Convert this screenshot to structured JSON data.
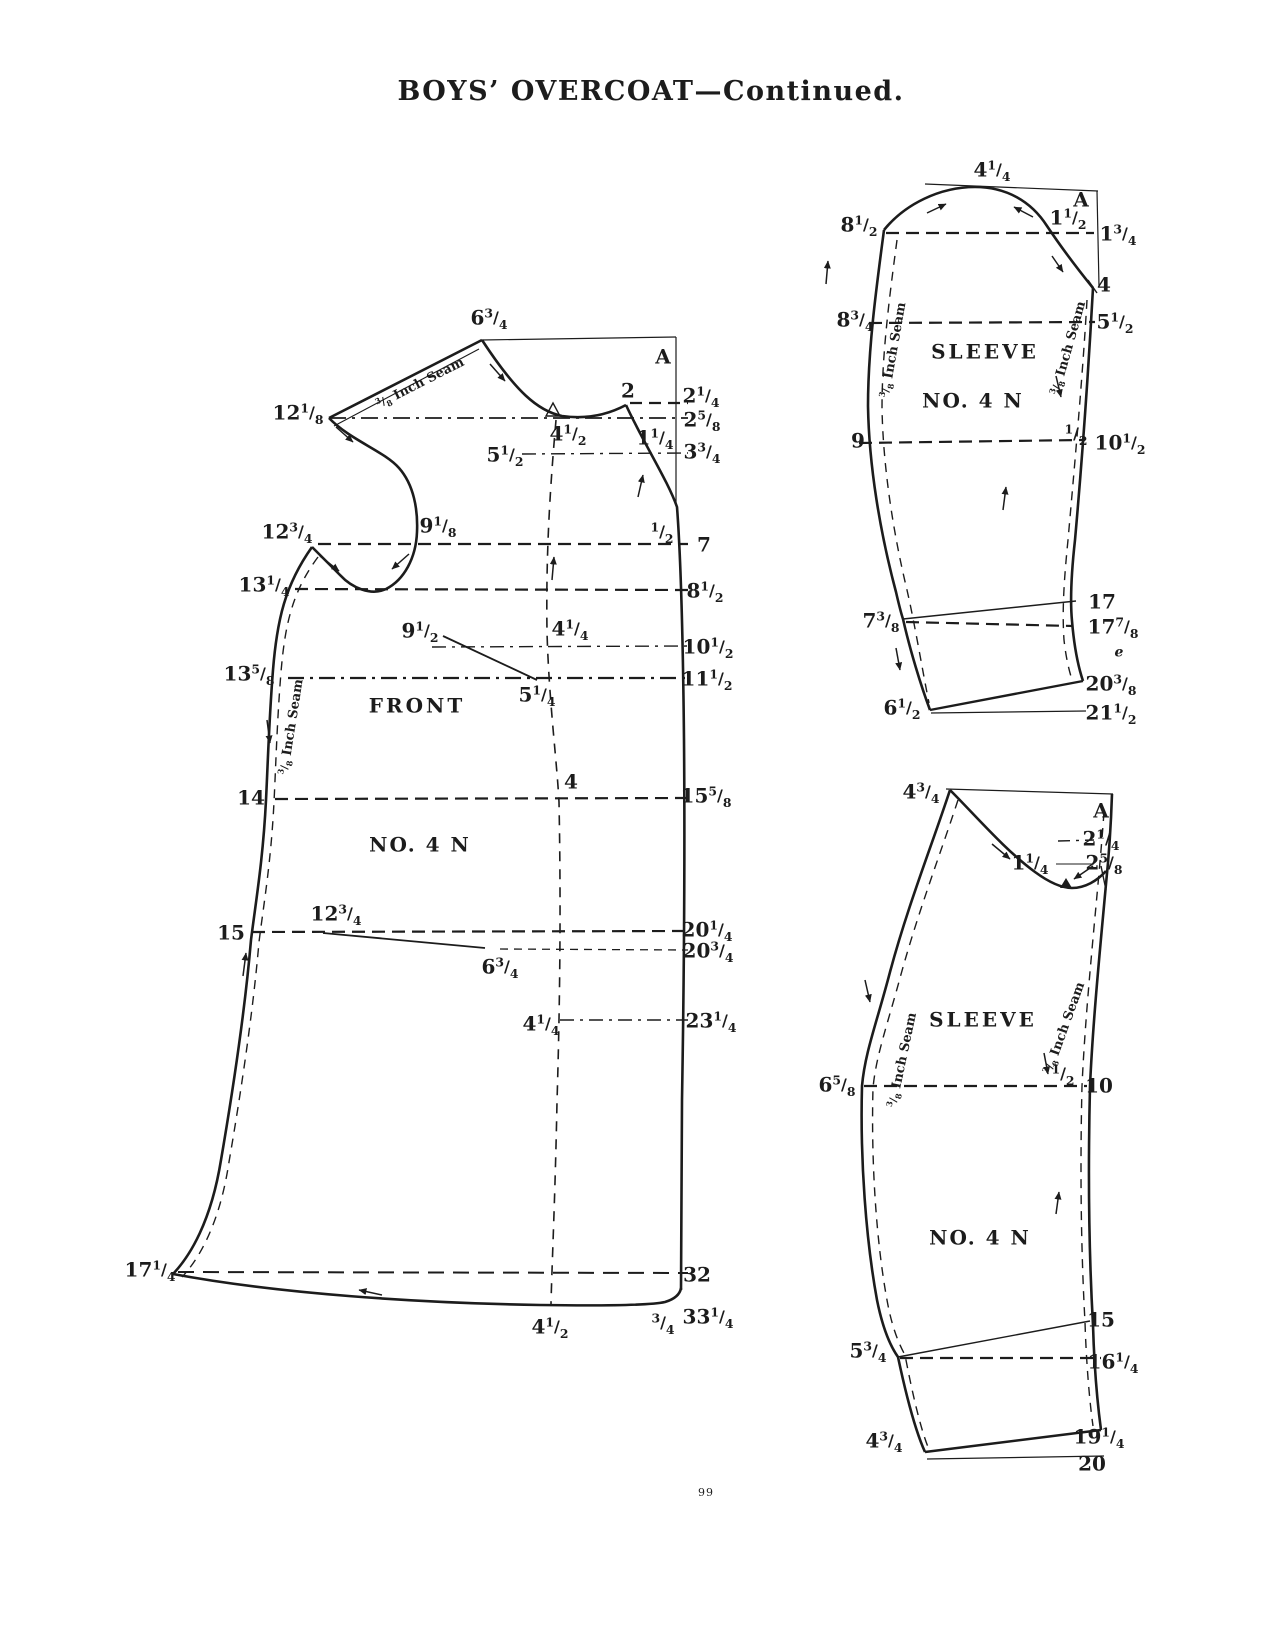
{
  "page": {
    "title": "BOYS’ OVERCOAT—Continued.",
    "page_number": "99"
  },
  "colors": {
    "ink": "#1c1c1c",
    "paper": "#ffffff"
  },
  "pieces": {
    "front": {
      "piece_name": "FRONT",
      "pattern_number": "NO. 4 N",
      "seam_note": "3/8 Inch Seam",
      "labels": [
        {
          "t": "6 3/4",
          "x": 489,
          "y": 318
        },
        {
          "t": "A",
          "x": 663,
          "y": 357,
          "k": "corner-letter"
        },
        {
          "t": "2",
          "x": 628,
          "y": 391
        },
        {
          "t": "2 1/4",
          "x": 701,
          "y": 396
        },
        {
          "t": "2 5/8",
          "x": 702,
          "y": 420
        },
        {
          "t": "4 1/2",
          "x": 568,
          "y": 434
        },
        {
          "t": "1 1/4",
          "x": 655,
          "y": 438
        },
        {
          "t": "5 1/2",
          "x": 505,
          "y": 455
        },
        {
          "t": "3 3/4",
          "x": 702,
          "y": 452
        },
        {
          "t": "12 1/8",
          "x": 298,
          "y": 413
        },
        {
          "t": "9 1/8",
          "x": 438,
          "y": 526
        },
        {
          "t": "12 3/4",
          "x": 287,
          "y": 532
        },
        {
          "t": "1/2",
          "x": 662,
          "y": 532
        },
        {
          "t": "7",
          "x": 704,
          "y": 545
        },
        {
          "t": "13 1/4",
          "x": 264,
          "y": 585
        },
        {
          "t": "8 1/2",
          "x": 705,
          "y": 591
        },
        {
          "t": "9 1/2",
          "x": 420,
          "y": 631
        },
        {
          "t": "4 1/4",
          "x": 570,
          "y": 629
        },
        {
          "t": "10 1/2",
          "x": 708,
          "y": 647
        },
        {
          "t": "13 5/8",
          "x": 249,
          "y": 674
        },
        {
          "t": "11 1/2",
          "x": 707,
          "y": 679
        },
        {
          "t": "5 1/4",
          "x": 537,
          "y": 695
        },
        {
          "t": "FRONT",
          "x": 417,
          "y": 706,
          "k": "piece-name",
          "sp": 3
        },
        {
          "t": "3/8 Inch Seam",
          "x": 420,
          "y": 383,
          "k": "seam-note",
          "r": -27,
          "s": 13
        },
        {
          "t": "3/8 Inch Seam",
          "x": 291,
          "y": 727,
          "k": "seam-note",
          "r": -81,
          "s": 13
        },
        {
          "t": "14",
          "x": 251,
          "y": 798
        },
        {
          "t": "4",
          "x": 571,
          "y": 782
        },
        {
          "t": "15 5/8",
          "x": 706,
          "y": 796
        },
        {
          "t": "NO. 4 N",
          "x": 420,
          "y": 845,
          "k": "piece-number",
          "sp": 2
        },
        {
          "t": "15",
          "x": 231,
          "y": 933
        },
        {
          "t": "12 3/4",
          "x": 336,
          "y": 914
        },
        {
          "t": "20 1/4",
          "x": 707,
          "y": 930
        },
        {
          "t": "20 3/4",
          "x": 708,
          "y": 951
        },
        {
          "t": "6 3/4",
          "x": 500,
          "y": 967
        },
        {
          "t": "4 1/4",
          "x": 541,
          "y": 1024
        },
        {
          "t": "23 1/4",
          "x": 711,
          "y": 1021
        },
        {
          "t": "17 1/4",
          "x": 150,
          "y": 1270
        },
        {
          "t": "32",
          "x": 697,
          "y": 1275
        },
        {
          "t": "33 1/4",
          "x": 708,
          "y": 1317
        },
        {
          "t": "4 1/2",
          "x": 550,
          "y": 1327
        },
        {
          "t": "3/4",
          "x": 663,
          "y": 1323
        }
      ]
    },
    "sleeve_top": {
      "piece_name": "SLEEVE",
      "pattern_number": "NO. 4 N",
      "seam_note": "3/8 Inch Seam",
      "labels": [
        {
          "t": "4 1/4",
          "x": 992,
          "y": 170
        },
        {
          "t": "A",
          "x": 1081,
          "y": 200,
          "k": "corner-letter"
        },
        {
          "t": "8 1/2",
          "x": 859,
          "y": 225
        },
        {
          "t": "1 1/2",
          "x": 1068,
          "y": 218
        },
        {
          "t": "1 3/4",
          "x": 1118,
          "y": 234
        },
        {
          "t": "8 3/4",
          "x": 855,
          "y": 320
        },
        {
          "t": "4",
          "x": 1104,
          "y": 285
        },
        {
          "t": "5 1/2",
          "x": 1115,
          "y": 322
        },
        {
          "t": "SLEEVE",
          "x": 985,
          "y": 352,
          "k": "piece-name",
          "sp": 3
        },
        {
          "t": "NO. 4 N",
          "x": 973,
          "y": 401,
          "k": "piece-number",
          "sp": 2
        },
        {
          "t": "3/8 Inch Seam",
          "x": 893,
          "y": 350,
          "k": "seam-note",
          "r": -80,
          "s": 13
        },
        {
          "t": "3/8 Inch Seam",
          "x": 1068,
          "y": 348,
          "k": "seam-note",
          "r": -74,
          "s": 13
        },
        {
          "t": "9",
          "x": 858,
          "y": 441
        },
        {
          "t": "1/2",
          "x": 1076,
          "y": 434
        },
        {
          "t": "10 1/2",
          "x": 1120,
          "y": 443
        },
        {
          "t": "7 3/8",
          "x": 881,
          "y": 621
        },
        {
          "t": "17",
          "x": 1102,
          "y": 602
        },
        {
          "t": "17 7/8",
          "x": 1113,
          "y": 627
        },
        {
          "t": "e",
          "x": 1119,
          "y": 652,
          "k": "stray-mark",
          "s": 14,
          "i": 1
        },
        {
          "t": "20 3/8",
          "x": 1111,
          "y": 684
        },
        {
          "t": "6 1/2",
          "x": 902,
          "y": 708
        },
        {
          "t": "21 1/2",
          "x": 1111,
          "y": 713
        }
      ]
    },
    "sleeve_under": {
      "piece_name": "SLEEVE",
      "pattern_number": "NO. 4 N",
      "seam_note": "3/8 Inch Seam",
      "labels": [
        {
          "t": "4 3/4",
          "x": 921,
          "y": 792
        },
        {
          "t": "A",
          "x": 1101,
          "y": 811,
          "k": "corner-letter"
        },
        {
          "t": "2 1/4",
          "x": 1101,
          "y": 839
        },
        {
          "t": "1 1/4",
          "x": 1030,
          "y": 863
        },
        {
          "t": "2 5/8",
          "x": 1104,
          "y": 863
        },
        {
          "t": "SLEEVE",
          "x": 983,
          "y": 1020,
          "k": "piece-name",
          "sp": 3
        },
        {
          "t": "3/8 Inch Seam",
          "x": 902,
          "y": 1060,
          "k": "seam-note",
          "r": -78,
          "s": 13
        },
        {
          "t": "3/8 Inch Seam",
          "x": 1064,
          "y": 1028,
          "k": "seam-note",
          "r": -70,
          "s": 13
        },
        {
          "t": "6 5/8",
          "x": 837,
          "y": 1085
        },
        {
          "t": "1/2",
          "x": 1063,
          "y": 1074
        },
        {
          "t": "10",
          "x": 1099,
          "y": 1086
        },
        {
          "t": "NO. 4 N",
          "x": 980,
          "y": 1238,
          "k": "piece-number",
          "sp": 2
        },
        {
          "t": "15",
          "x": 1101,
          "y": 1320
        },
        {
          "t": "5 3/4",
          "x": 868,
          "y": 1351
        },
        {
          "t": "16 1/4",
          "x": 1113,
          "y": 1362
        },
        {
          "t": "19 1/4",
          "x": 1099,
          "y": 1437
        },
        {
          "t": "4 3/4",
          "x": 884,
          "y": 1441
        },
        {
          "t": "20",
          "x": 1092,
          "y": 1464
        }
      ]
    }
  }
}
